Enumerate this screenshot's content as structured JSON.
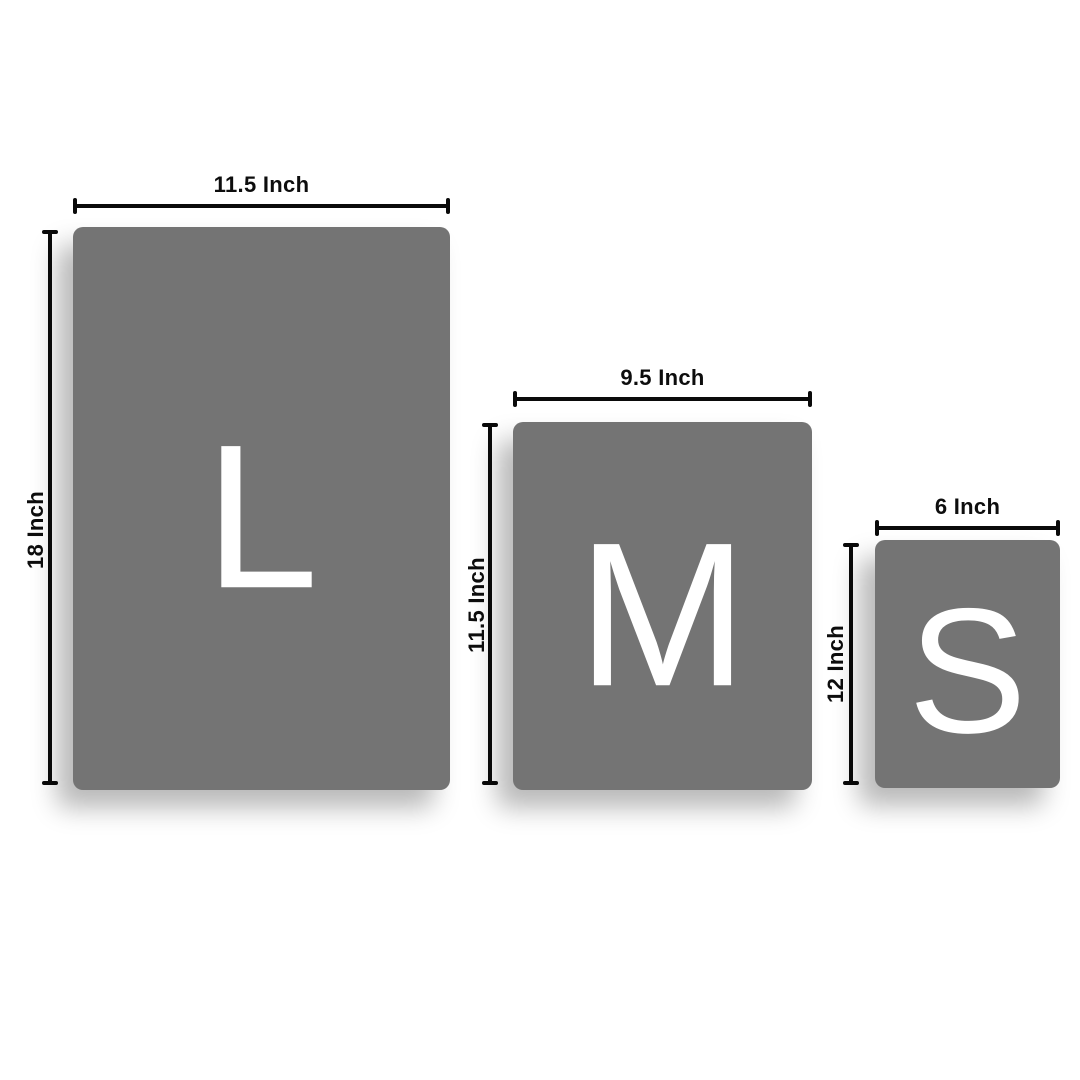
{
  "title": "size-comparison-diagram",
  "colors": {
    "background": "#ffffff",
    "panel": "#747474",
    "letter": "#ffffff",
    "line": "#0a0a0a",
    "label_text": "#0d0d0d"
  },
  "sizes": [
    {
      "letter": "L",
      "width_label": "11.5 Inch",
      "height_label": "18 Inch"
    },
    {
      "letter": "M",
      "width_label": "9.5 Inch",
      "height_label": "11.5 Inch"
    },
    {
      "letter": "S",
      "width_label": "6 Inch",
      "height_label": "12 Inch"
    }
  ]
}
